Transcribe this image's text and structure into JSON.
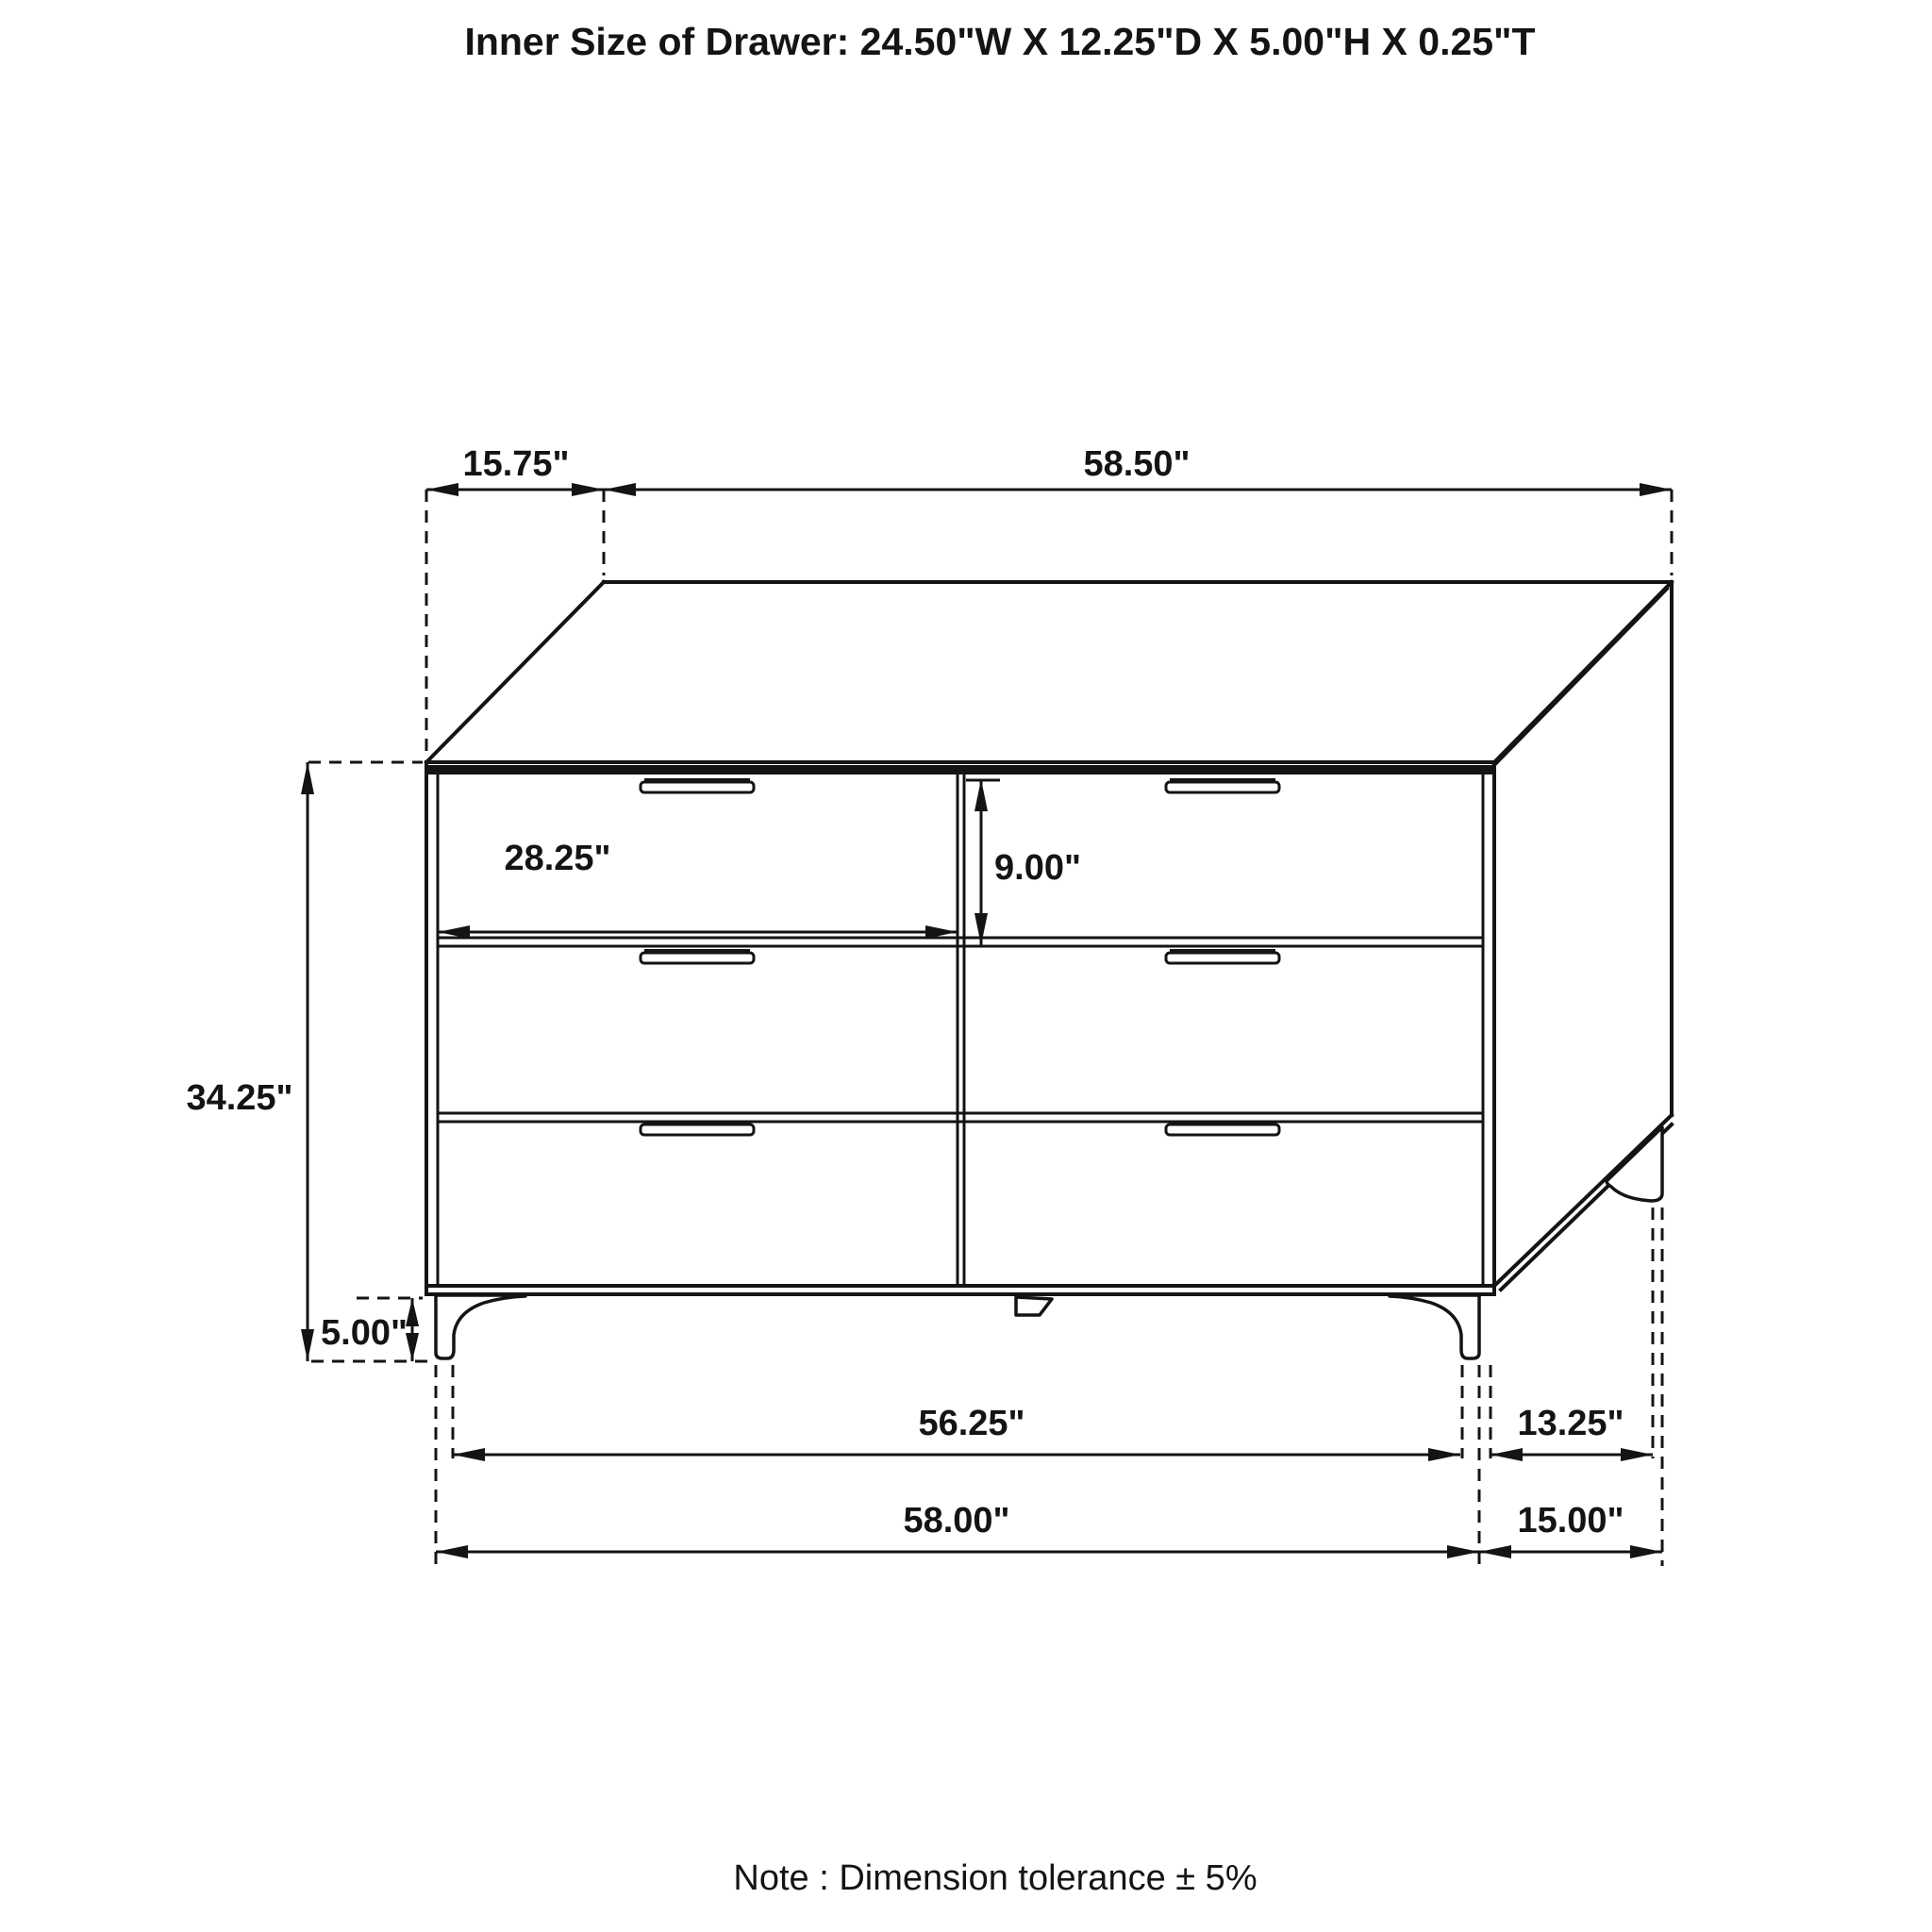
{
  "header": {
    "title": "Inner Size of Drawer: 24.50\"W X 12.25\"D X 5.00\"H X 0.25\"T"
  },
  "footer": {
    "note": "Note : Dimension tolerance ± 5%"
  },
  "diagram": {
    "type": "furniture dimension drawing",
    "subject": "six-drawer dresser shown in oblique projection",
    "drawer_count": 6,
    "line_color": "#141414",
    "background_color": "#ffffff",
    "dims": {
      "top_offset": "15.75\"",
      "top_width": "58.50\"",
      "height": "34.25\"",
      "drawer_width": "28.25\"",
      "drawer_height": "9.00\"",
      "leg_height": "5.00\"",
      "feet_inner_width": "56.25\"",
      "overall_width": "58.00\"",
      "side_feet_offset": "13.25\"",
      "side_depth": "15.00\""
    }
  }
}
